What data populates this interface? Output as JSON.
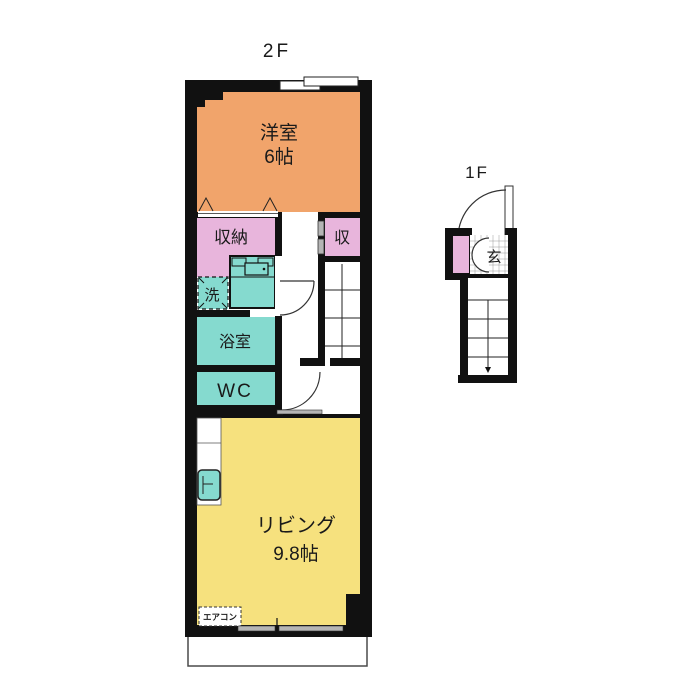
{
  "plans": {
    "second_floor": {
      "title": "2F",
      "rooms": {
        "western_room": {
          "name": "洋室",
          "size": "6帖",
          "color": "#F1A46B"
        },
        "closet_large": {
          "name": "収納",
          "color": "#E8B5DC"
        },
        "closet_small": {
          "name": "収",
          "color": "#E8B5DC"
        },
        "laundry": {
          "name": "洗",
          "color": "#85DACF"
        },
        "bathroom": {
          "name": "浴室",
          "color": "#85DACF"
        },
        "toilet": {
          "name": "WC",
          "color": "#85DACF"
        },
        "living": {
          "name": "リビング",
          "size": "9.8帖",
          "color": "#F6E17E"
        }
      },
      "aircon_label": "エアコン"
    },
    "first_floor": {
      "title": "1F",
      "entrance_label": "玄",
      "closet_color": "#E8B5DC"
    }
  },
  "colors": {
    "wall": "#111111",
    "orange_room": "#F1A46B",
    "pink_closet": "#E8B5DC",
    "teal_wet_area": "#85DACF",
    "yellow_living": "#F6E17E",
    "door_gray": "#B5B5B5",
    "background": "#FFFFFF"
  }
}
